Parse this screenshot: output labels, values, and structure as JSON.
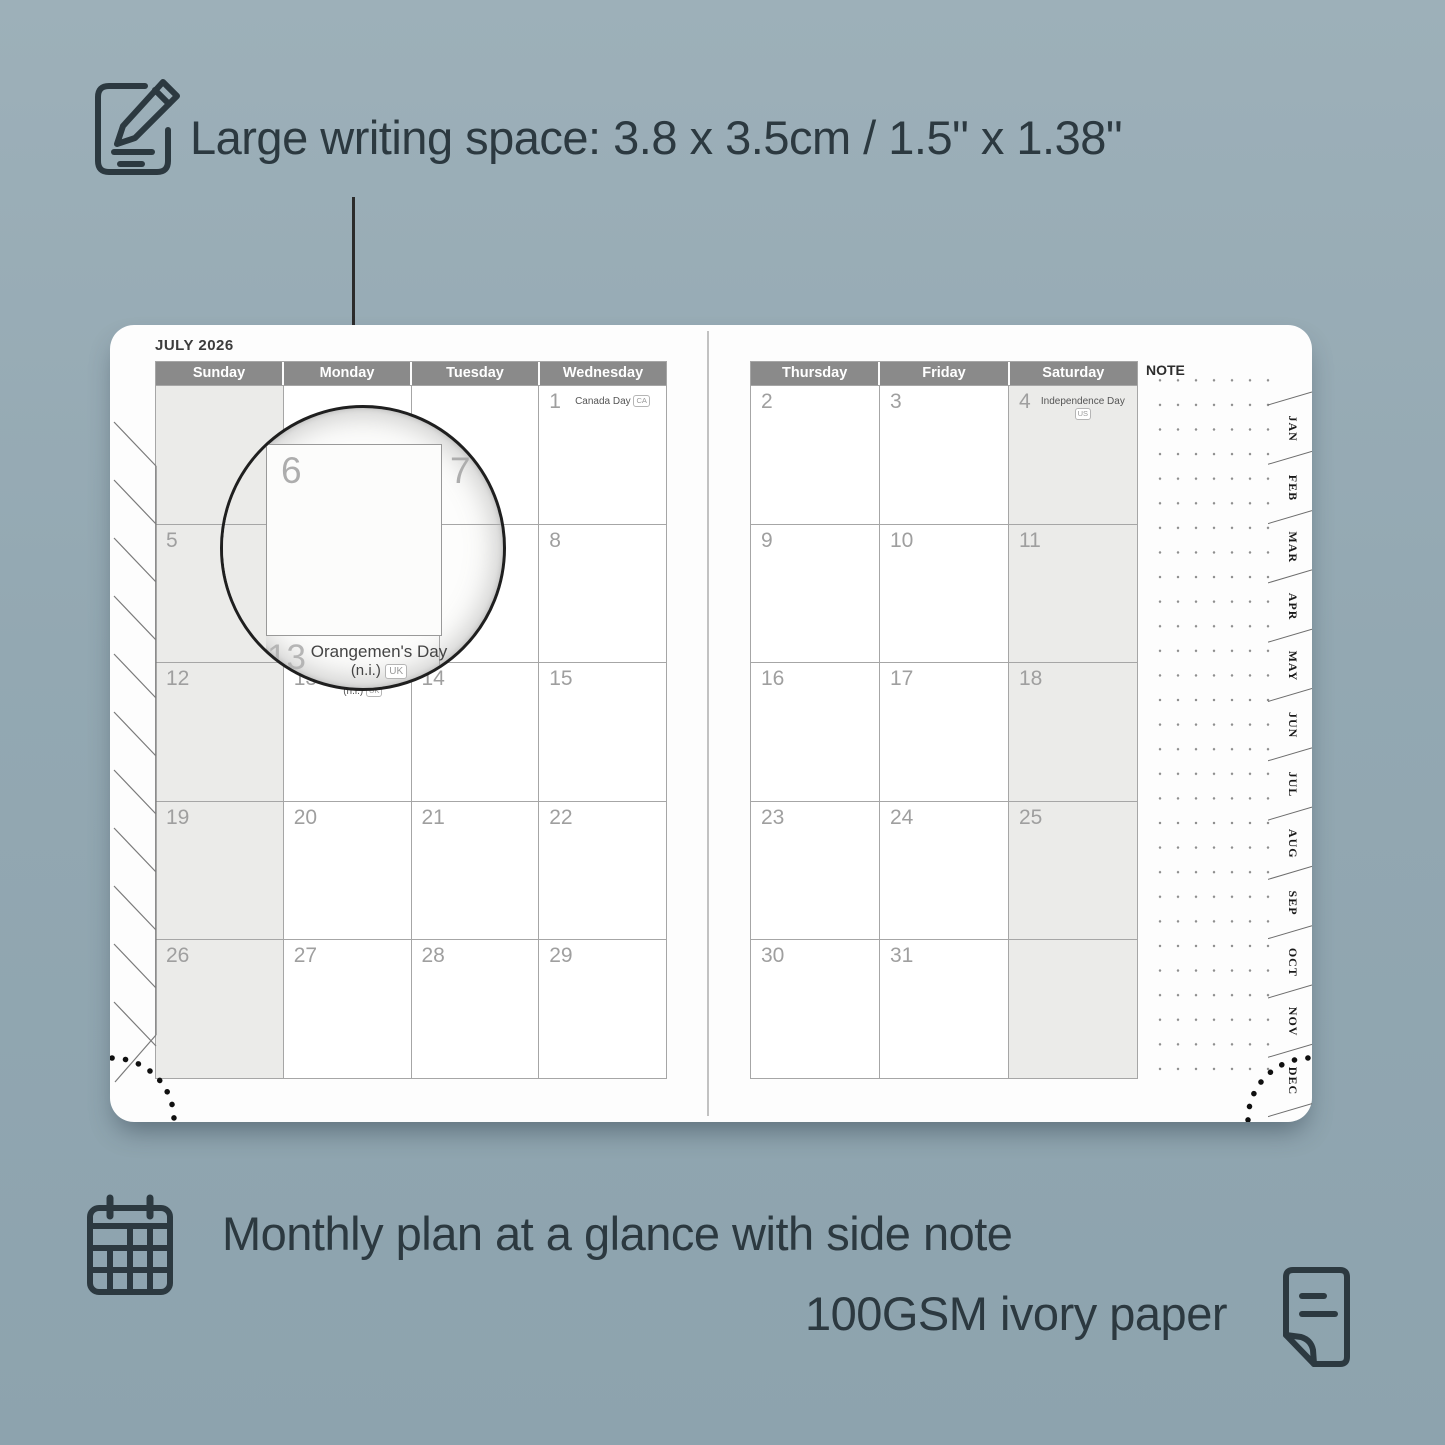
{
  "annotations": {
    "top_text": "Large writing space: 3.8 x 3.5cm / 1.5\" x 1.38\"",
    "bottom_line1": "Monthly plan at a glance with side note",
    "bottom_line2": "100GSM ivory paper"
  },
  "planner": {
    "month_title": "JULY 2026",
    "note_label": "NOTE",
    "left_page": {
      "day_headers": [
        "Sunday",
        "Monday",
        "Tuesday",
        "Wednesday"
      ],
      "weeks": [
        [
          {
            "day": ""
          },
          {
            "day": ""
          },
          {
            "day": ""
          },
          {
            "day": "1",
            "holiday": "Canada Day",
            "badge": "CA"
          }
        ],
        [
          {
            "day": "5"
          },
          {
            "day": "6"
          },
          {
            "day": "7"
          },
          {
            "day": "8"
          }
        ],
        [
          {
            "day": "12"
          },
          {
            "day": "13",
            "holiday": "Orangemen's Day",
            "suffix": "(n.i.)",
            "badge": "UK"
          },
          {
            "day": "14"
          },
          {
            "day": "15"
          }
        ],
        [
          {
            "day": "19"
          },
          {
            "day": "20"
          },
          {
            "day": "21"
          },
          {
            "day": "22"
          }
        ],
        [
          {
            "day": "26"
          },
          {
            "day": "27"
          },
          {
            "day": "28"
          },
          {
            "day": "29"
          }
        ]
      ]
    },
    "right_page": {
      "day_headers": [
        "Thursday",
        "Friday",
        "Saturday"
      ],
      "weeks": [
        [
          {
            "day": "2"
          },
          {
            "day": "3"
          },
          {
            "day": "4",
            "holiday": "Independence Day",
            "badge": "US"
          }
        ],
        [
          {
            "day": "9"
          },
          {
            "day": "10"
          },
          {
            "day": "11"
          }
        ],
        [
          {
            "day": "16"
          },
          {
            "day": "17"
          },
          {
            "day": "18"
          }
        ],
        [
          {
            "day": "23"
          },
          {
            "day": "24"
          },
          {
            "day": "25"
          }
        ],
        [
          {
            "day": "30"
          },
          {
            "day": "31"
          },
          {
            "day": ""
          }
        ]
      ]
    },
    "month_tabs": [
      "JAN",
      "FEB",
      "MAR",
      "APR",
      "MAY",
      "JUN",
      "JUL",
      "AUG",
      "SEP",
      "OCT",
      "NOV",
      "DEC"
    ],
    "magnifier": {
      "day_large": "6",
      "day_next": "7",
      "day_below": "13",
      "holiday_name": "Orangemen's Day",
      "holiday_suffix": "(n.i.)",
      "badge": "UK"
    }
  },
  "colors": {
    "background": "#93a8b2",
    "annotation_text": "#2c3940",
    "header_bar": "#8a8a8a",
    "weekend_shade": "#ebebe9",
    "grid_line": "#a6a6a6",
    "page_white": "#fdfdfd"
  }
}
